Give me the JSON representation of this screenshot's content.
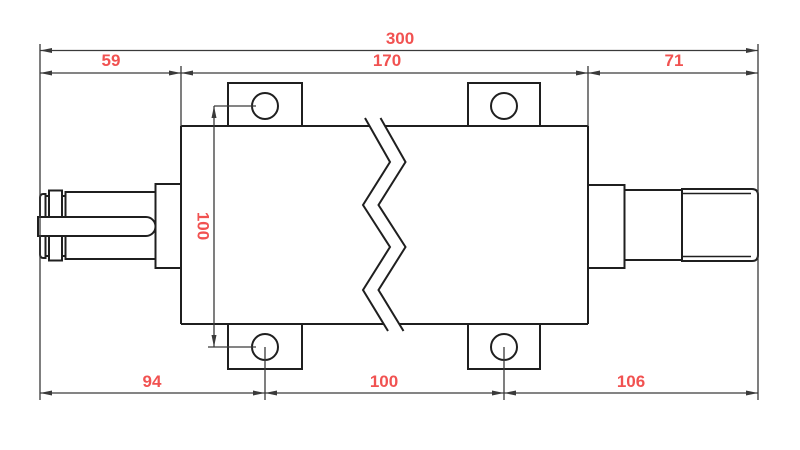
{
  "drawing": {
    "dimensions": {
      "overall_length": "300",
      "left_shaft_length": "59",
      "body_length": "170",
      "right_shaft_length": "71",
      "hole_spacing_vertical": "100",
      "left_hole_offset": "94",
      "hole_spacing_horizontal": "100",
      "right_hole_offset": "106"
    },
    "colors": {
      "dimension_text": "#f15251",
      "line": "#1f1f1f",
      "background": "#ffffff"
    }
  }
}
